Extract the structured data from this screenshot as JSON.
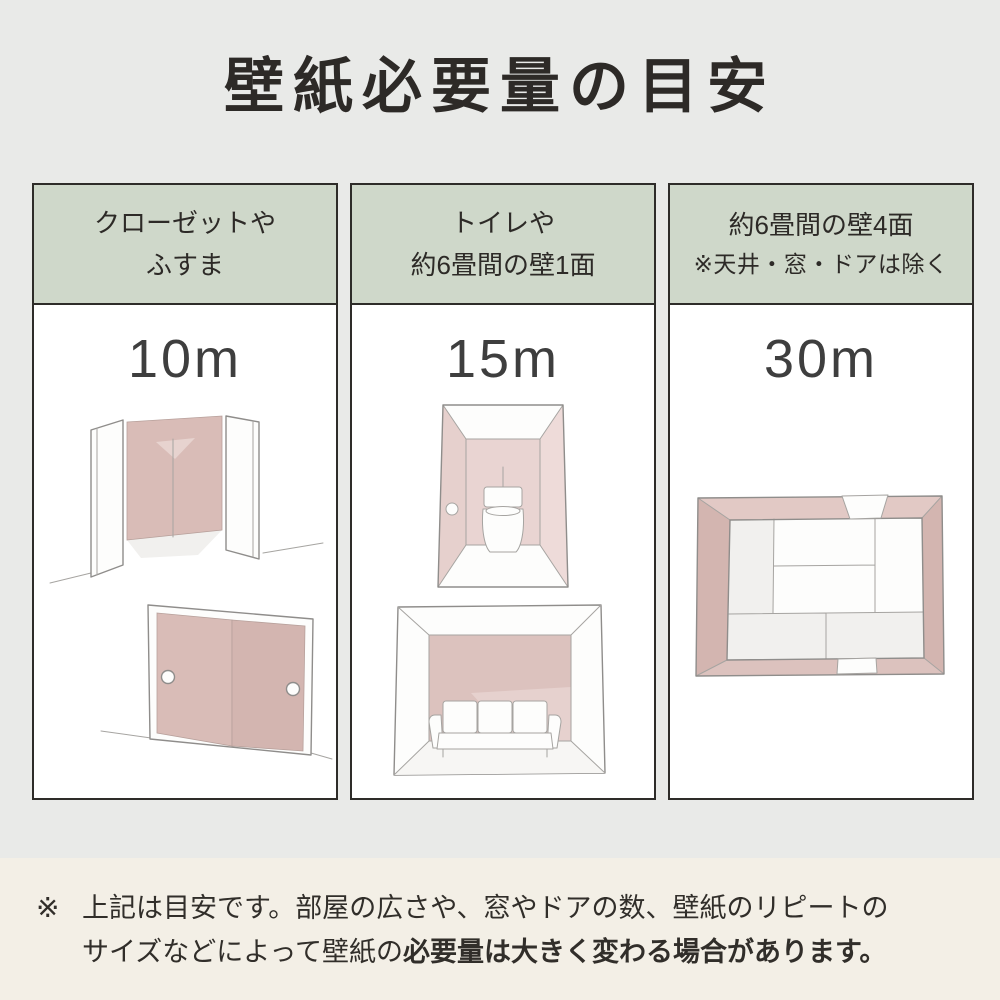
{
  "page": {
    "title": "壁紙必要量の目安"
  },
  "columns": [
    {
      "header_line1": "クローゼットや",
      "header_line2": "ふすま",
      "value": "10m",
      "illustrations": [
        "open-closet",
        "fusuma-sliding-doors"
      ]
    },
    {
      "header_line1": "トイレや",
      "header_line2": "約6畳間の壁1面",
      "value": "15m",
      "illustrations": [
        "toilet-room",
        "room-single-accent-wall"
      ]
    },
    {
      "header_line1": "約6畳間の壁4面",
      "header_line2": "※天井・窓・ドアは除く",
      "value": "30m",
      "illustrations": [
        "room-four-walls-top-view"
      ]
    }
  ],
  "note": {
    "marker": "※",
    "line1": "上記は目安です。部屋の広さや、窓やドアの数、壁紙のリピートの",
    "line2_normal": "サイズなどによって壁紙の",
    "line2_bold": "必要量は大きく変わる場合があります。"
  },
  "colors": {
    "background": "#e9eae8",
    "note_background": "#f3efe6",
    "header_green": "#cfd8ca",
    "card_border": "#2e2c29",
    "accent_pink": "#d9bcb7",
    "text": "#2d2a27"
  }
}
